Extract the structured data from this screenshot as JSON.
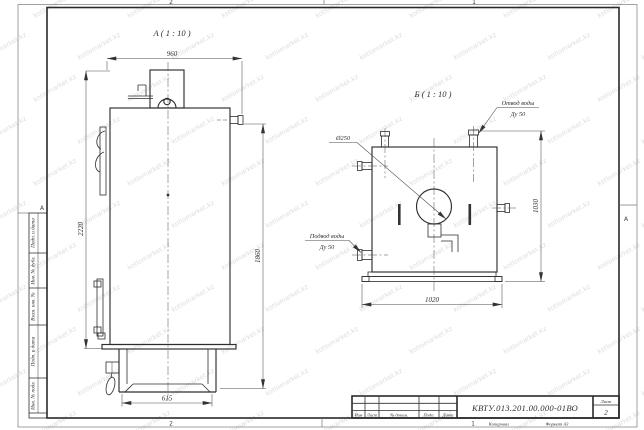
{
  "sheet": {
    "zone_top_left": "2",
    "zone_top_right": "1",
    "zone_bottom_left": "2",
    "zone_bottom_right": "1",
    "margin_letter_left": "А",
    "margin_letter_right": "А",
    "footer": {
      "kopiroval": "Копировал",
      "format": "Формат А3"
    },
    "side_labels": [
      "Подп. и дата",
      "Инв. № дубл.",
      "Взам. инв. №",
      "Подп. и дата",
      "Инв. № подл."
    ]
  },
  "watermark": {
    "text": "kotlomarket.kz"
  },
  "views": {
    "a": {
      "title": "А ( 1 : 10 )",
      "dim_width_top": "960",
      "dim_height_total": "2220",
      "dim_height_right": "1860",
      "dim_base_width": "615"
    },
    "b": {
      "title": "Б ( 1 : 10 )",
      "flue_dia": "Ø250",
      "dim_width": "1020",
      "dim_height": "1030",
      "outlet_line1": "Отвод воды",
      "outlet_line2": "Ду 50",
      "inlet_line1": "Подвод воды",
      "inlet_line2": "Ду 50"
    }
  },
  "title_block": {
    "designation": "КВТУ.013.201.00.000-01ВО",
    "sheet_label": "Лист",
    "sheet_number": "2",
    "col_izm": "Изм",
    "col_list": "Лист",
    "col_ndoc": "№ докум.",
    "col_podp": "Подп.",
    "col_data": "Дата"
  }
}
